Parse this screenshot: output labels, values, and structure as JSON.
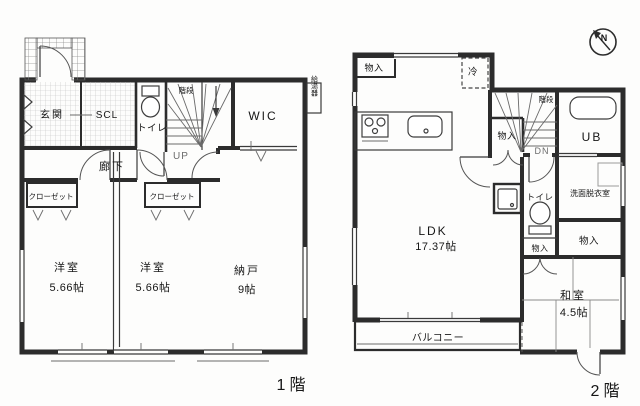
{
  "compass": {
    "north": "N"
  },
  "floor1": {
    "floor_label": "1階",
    "entrance": "玄関",
    "scl": "SCL",
    "toilet": "トイレ",
    "stairs": "階段",
    "up": "UP",
    "wic": "WIC",
    "water_heater": "給湯器",
    "hallway": "廊下",
    "closet_left": "クローゼット",
    "closet_right": "クローゼット",
    "western1_name": "洋室",
    "western1_size": "5.66帖",
    "western2_name": "洋室",
    "western2_size": "5.66帖",
    "storage_name": "納戸",
    "storage_size": "9帖"
  },
  "floor2": {
    "floor_label": "2階",
    "storage_top_left": "物入",
    "fridge": "冷",
    "stairs": "階段",
    "dn": "DN",
    "storage_stairs": "物入",
    "ub": "UB",
    "toilet": "トイレ",
    "washroom": "洗面脱衣室",
    "storage_mid": "物入",
    "storage_right": "物入",
    "ldk_name": "LDK",
    "ldk_size": "17.37帖",
    "japanese_name": "和室",
    "japanese_size": "4.5帖",
    "balcony": "バルコニー"
  }
}
